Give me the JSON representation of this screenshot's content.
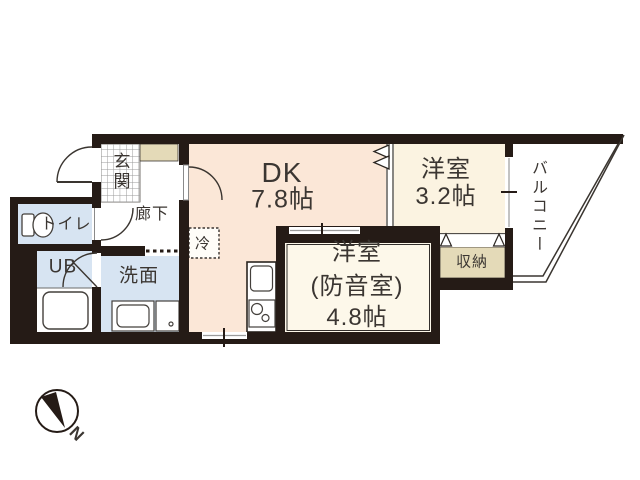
{
  "rooms": {
    "entrance": {
      "label": "玄関"
    },
    "corridor": {
      "label": "廊下"
    },
    "toilet": {
      "label": "トイレ"
    },
    "unit_bath": {
      "label": "UB"
    },
    "washroom": {
      "label": "洗面"
    },
    "dining_kitchen": {
      "label": "DK",
      "size": "7.8帖"
    },
    "refrigerator": {
      "label": "冷"
    },
    "soundproof_room": {
      "label": "洋室",
      "sub_label": "(防音室)",
      "size": "4.8帖"
    },
    "western_room": {
      "label": "洋室",
      "size": "3.2帖"
    },
    "closet": {
      "label": "収納"
    },
    "balcony": {
      "label": "バルコニー"
    }
  },
  "compass": {
    "north_label": "N"
  },
  "colors": {
    "wall": "#251b16",
    "dk_fill": "#fbe7d7",
    "soundproof_fill": "#fdf8ea",
    "western_fill": "#fbf3e1",
    "wet_fill": "#d7e4f2",
    "closet_fill": "#e4dab8",
    "outline": "#3a3530"
  }
}
